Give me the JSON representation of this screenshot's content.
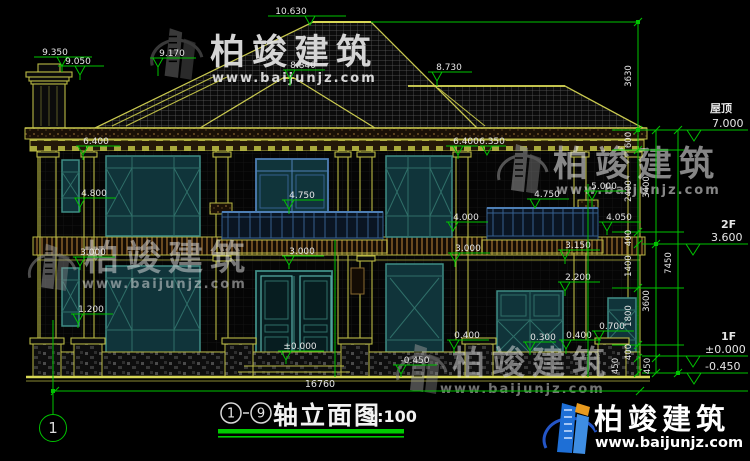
{
  "brand": {
    "name": "柏竣建筑",
    "url": "www.baijunjz.com"
  },
  "title_block": {
    "axis_from": "1",
    "axis_to": "9",
    "name": "轴立面图",
    "scale": "1:100"
  },
  "axis_bubble": {
    "label": "1"
  },
  "floor_labels": {
    "roof": {
      "name": "屋顶",
      "level": "7.000"
    },
    "f2": {
      "name": "2F",
      "level": "3.600"
    },
    "f1": {
      "name": "1F",
      "level": "±0.000"
    },
    "ground": {
      "level": "-0.450"
    }
  },
  "markers": [
    {
      "label": "10.630"
    },
    {
      "label": "9.350"
    },
    {
      "label": "9.050"
    },
    {
      "label": "9.170"
    },
    {
      "label": "8.840"
    },
    {
      "label": "8.730"
    },
    {
      "label": "6.400"
    },
    {
      "label": "6.400"
    },
    {
      "label": "6.350"
    },
    {
      "label": "4.800"
    },
    {
      "label": "5.000"
    },
    {
      "label": "4.750"
    },
    {
      "label": "4.750"
    },
    {
      "label": "4.000"
    },
    {
      "label": "4.050"
    },
    {
      "label": "3.150"
    },
    {
      "label": "3.000"
    },
    {
      "label": "3.000"
    },
    {
      "label": "3.000"
    },
    {
      "label": "2.200"
    },
    {
      "label": "1.200"
    },
    {
      "label": "0.700"
    },
    {
      "label": "0.400"
    },
    {
      "label": "0.300"
    },
    {
      "label": "0.400"
    },
    {
      "label": "±0.000"
    },
    {
      "label": "-0.450"
    }
  ],
  "dim_chains": {
    "a": [
      "3630",
      "600",
      "2400",
      "400",
      "1400",
      "1800",
      "400",
      "450"
    ],
    "b": [
      "3400",
      "3600",
      "450"
    ],
    "c": [
      "7450"
    ],
    "bottom": "16760"
  }
}
